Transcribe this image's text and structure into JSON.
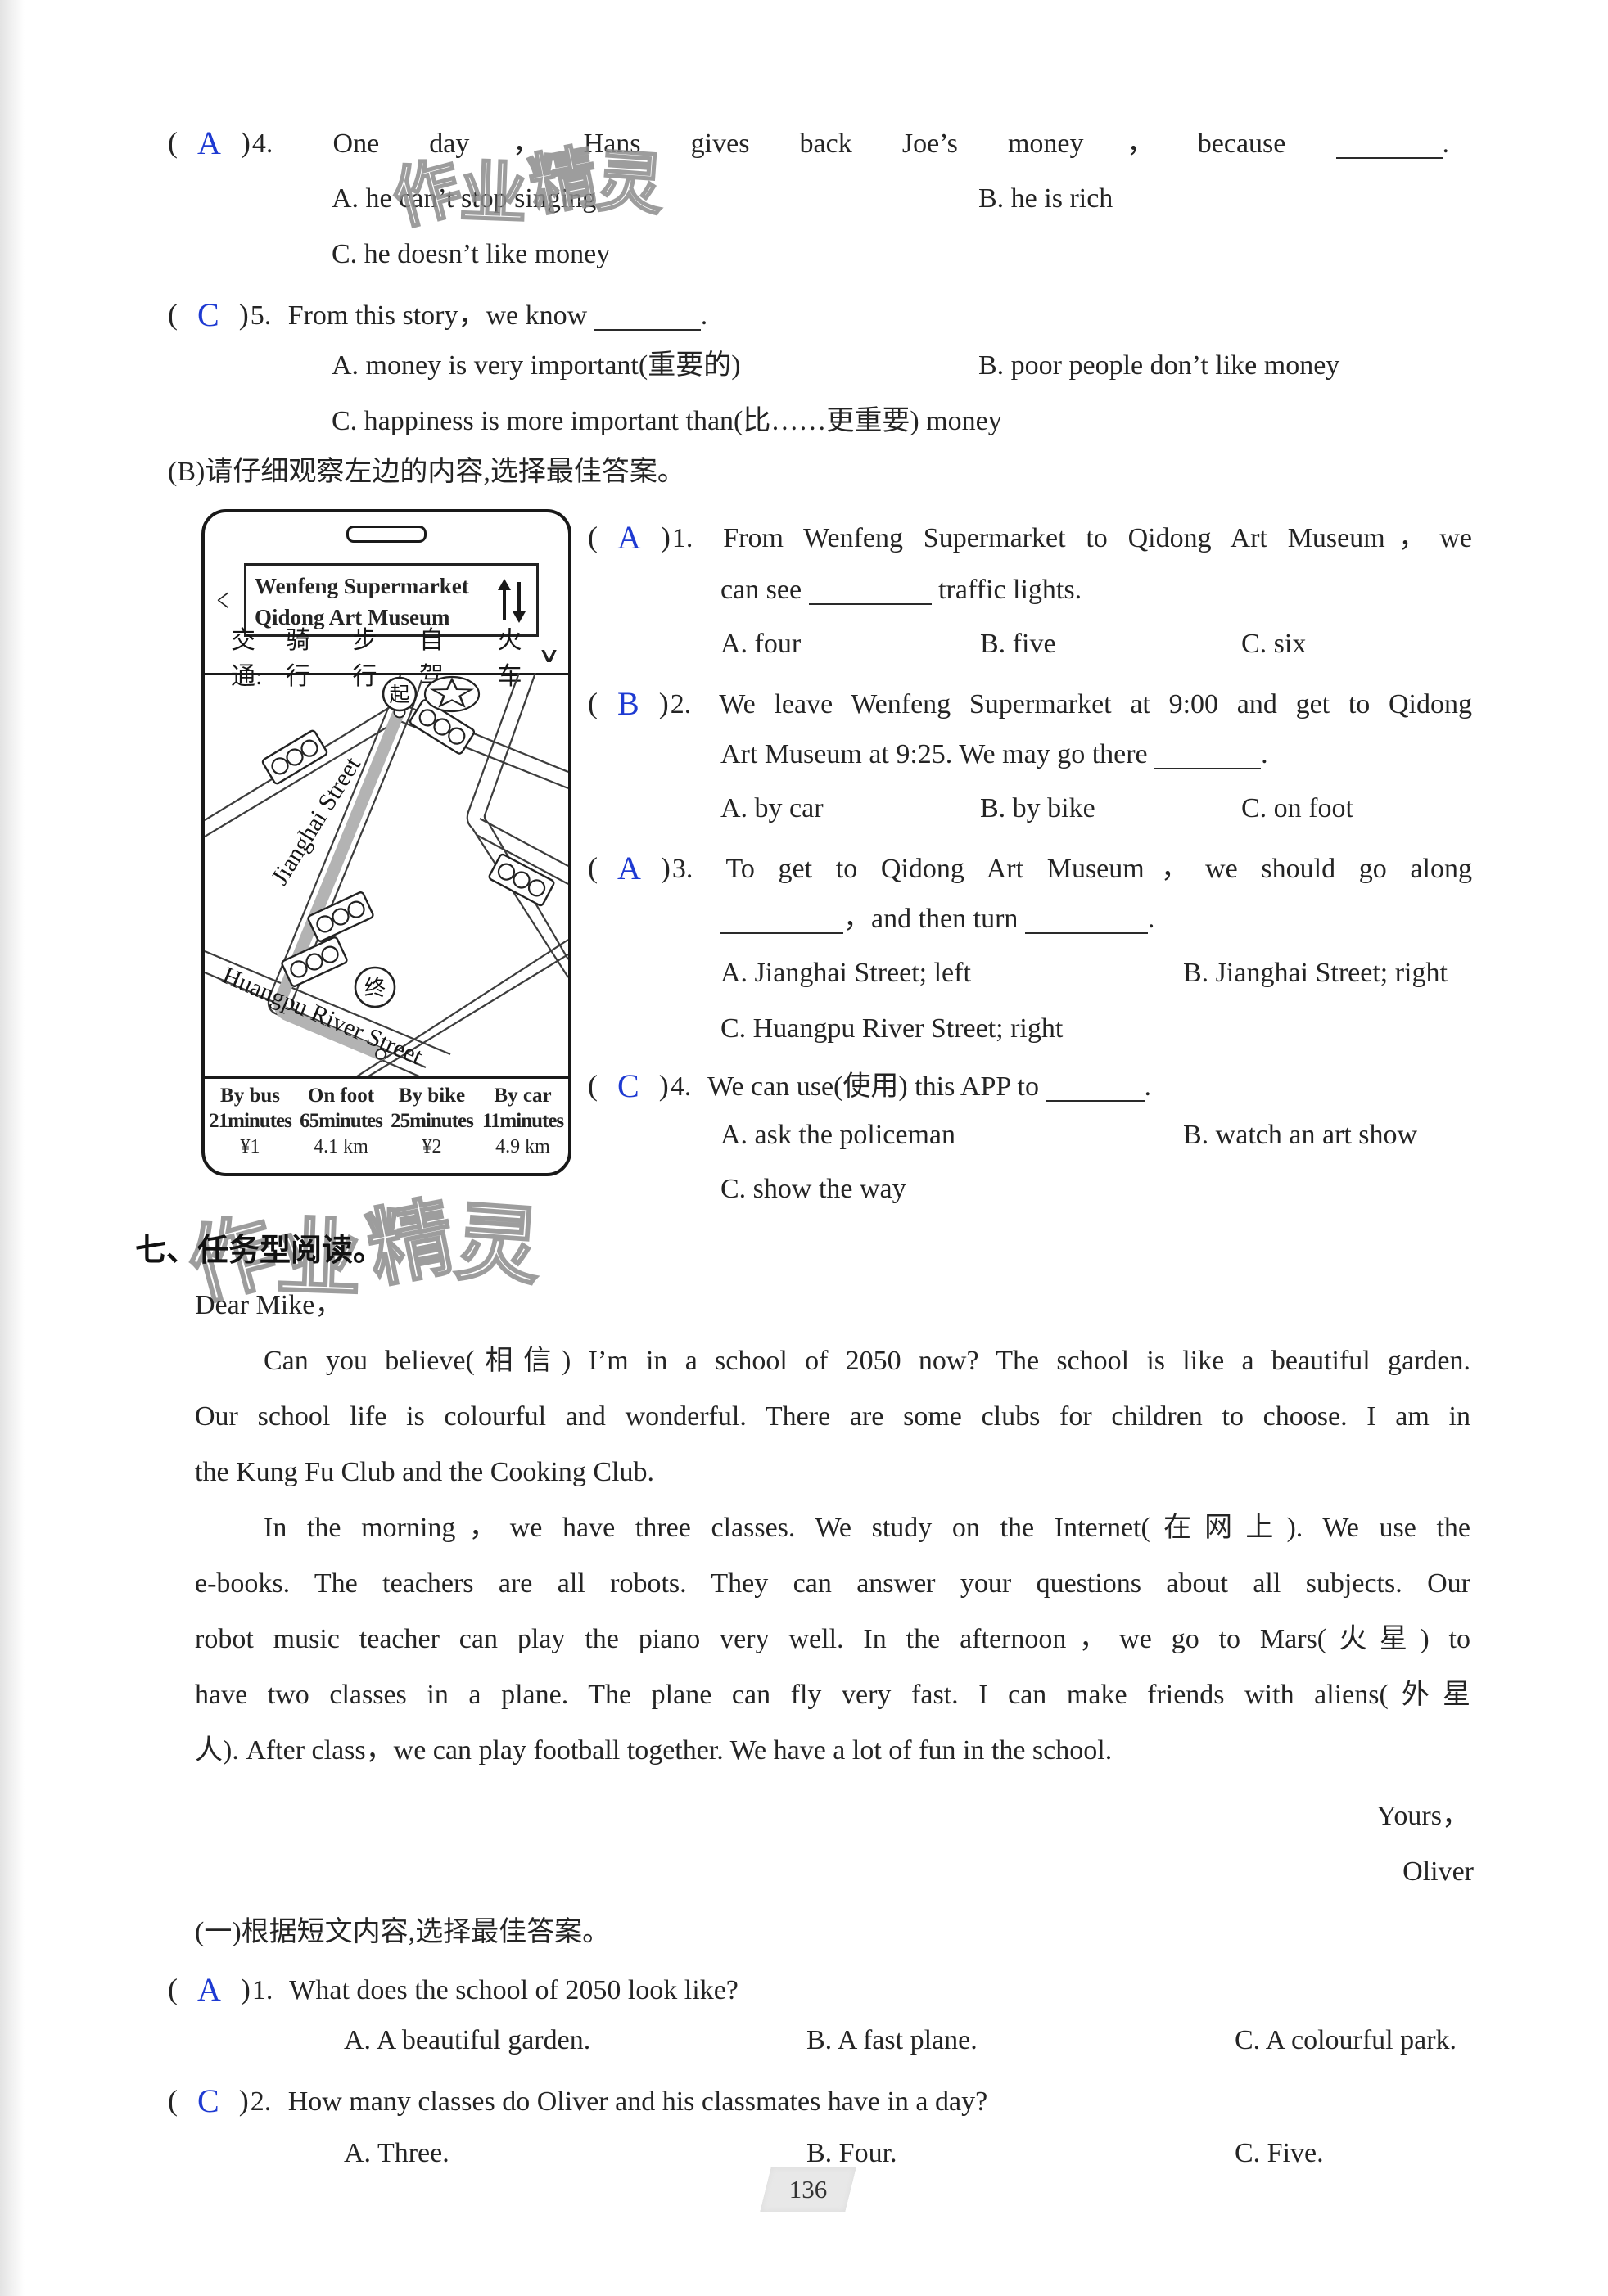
{
  "page": {
    "number": "136"
  },
  "colors": {
    "answer": "#1e3ad2",
    "ink": "#242424"
  },
  "watermark": {
    "c1": "作",
    "c2": "业",
    "c3": "精",
    "c4": "灵"
  },
  "partA": {
    "q4": {
      "open": "(",
      "answer": "A",
      "close": ")",
      "number": "4.",
      "stem": "One day，Hans gives back Joe’s money，because",
      "tail": ".",
      "optA": "A. he can’t stop singing",
      "optB": "B. he is rich",
      "optC": "C. he doesn’t like money"
    },
    "q5": {
      "open": "(",
      "answer": "C",
      "close": ")",
      "number": "5.",
      "stem": "From this story，we know",
      "tail": ".",
      "optA": "A. money is very important(重要的)",
      "optB": "B. poor people don’t like money",
      "optC": "C. happiness is more important than(比……更重要) money"
    },
    "partB_heading": "(B)请仔细观察左边的内容,选择最佳答案。"
  },
  "phone": {
    "back": "<",
    "search1": "Wenfeng Supermarket",
    "search2": "Qidong Art Museum",
    "transport_label": "交通:",
    "m1": "骑行",
    "m2": "步行",
    "m3": "自驾",
    "m4": "火车",
    "chevron": "∨",
    "map": {
      "start": "起",
      "end": "终",
      "street1": "Jianghai Street",
      "street2": "Huangpu River Street"
    },
    "table": {
      "c1": {
        "h": "By bus",
        "t": "21minutes",
        "v": "¥1"
      },
      "c2": {
        "h": "On foot",
        "t": "65minutes",
        "v": "4.1 km"
      },
      "c3": {
        "h": "By bike",
        "t": "25minutes",
        "v": "¥2"
      },
      "c4": {
        "h": "By car",
        "t": "11minutes",
        "v": "4.9 km"
      }
    }
  },
  "partB": {
    "q1": {
      "open": "(",
      "answer": "A",
      "close": ")",
      "number": "1.",
      "line1": "From Wenfeng Supermarket to Qidong Art Museum，we",
      "line2a": "can see",
      "line2b": "traffic lights.",
      "optA": "A. four",
      "optB": "B. five",
      "optC": "C. six"
    },
    "q2": {
      "open": "(",
      "answer": "B",
      "close": ")",
      "number": "2.",
      "line1": "We leave Wenfeng Supermarket at 9:00 and get to Qidong",
      "line2a": "Art Museum at 9:25. We may go there",
      "tail": ".",
      "optA": "A. by car",
      "optB": "B. by bike",
      "optC": "C. on foot"
    },
    "q3": {
      "open": "(",
      "answer": "A",
      "close": ")",
      "number": "3.",
      "line1": "To get to Qidong Art Museum，we should go along",
      "line2a": "，and then turn",
      "tail": ".",
      "optA": "A. Jianghai Street; left",
      "optB": "B. Jianghai Street; right",
      "optC": "C. Huangpu River Street; right"
    },
    "q4": {
      "open": "(",
      "answer": "C",
      "close": ")",
      "number": "4.",
      "line1": "We can use(使用) this APP to",
      "tail": ".",
      "optA": "A. ask the policeman",
      "optB": "B. watch an art show",
      "optC": "C. show the way"
    }
  },
  "part7": {
    "heading": "七、任务型阅读。",
    "letter": {
      "salutation": "Dear Mike，",
      "lines": [
        "Can you believe(相信) I’m in a school of 2050 now? The school is like a beautiful garden.",
        "Our school life is colourful and wonderful. There are some clubs for children to choose. I am in",
        "the Kung Fu Club and the Cooking Club.",
        "In the morning，we have three classes. We study on the Internet(在网上). We use the",
        "e-books. The teachers are all robots. They can answer your questions about all subjects. Our",
        "robot music teacher can play the piano very well. In the afternoon，we go to Mars(火星) to",
        "have two classes in a plane. The plane can fly very fast. I can make friends with aliens(外星",
        "人). After class，we can play football together. We have a lot of fun in the school."
      ],
      "closing": "Yours，",
      "signature": "Oliver"
    },
    "sub_heading": "(一)根据短文内容,选择最佳答案。",
    "q1": {
      "open": "(",
      "answer": "A",
      "close": ")",
      "number": "1.",
      "stem": "What does the school of 2050 look like?",
      "optA": "A. A beautiful garden.",
      "optB": "B. A fast plane.",
      "optC": "C. A colourful park."
    },
    "q2": {
      "open": "(",
      "answer": "C",
      "close": ")",
      "number": "2.",
      "stem": "How many classes do Oliver and his classmates have in a day?",
      "optA": "A. Three.",
      "optB": "B. Four.",
      "optC": "C. Five."
    }
  }
}
